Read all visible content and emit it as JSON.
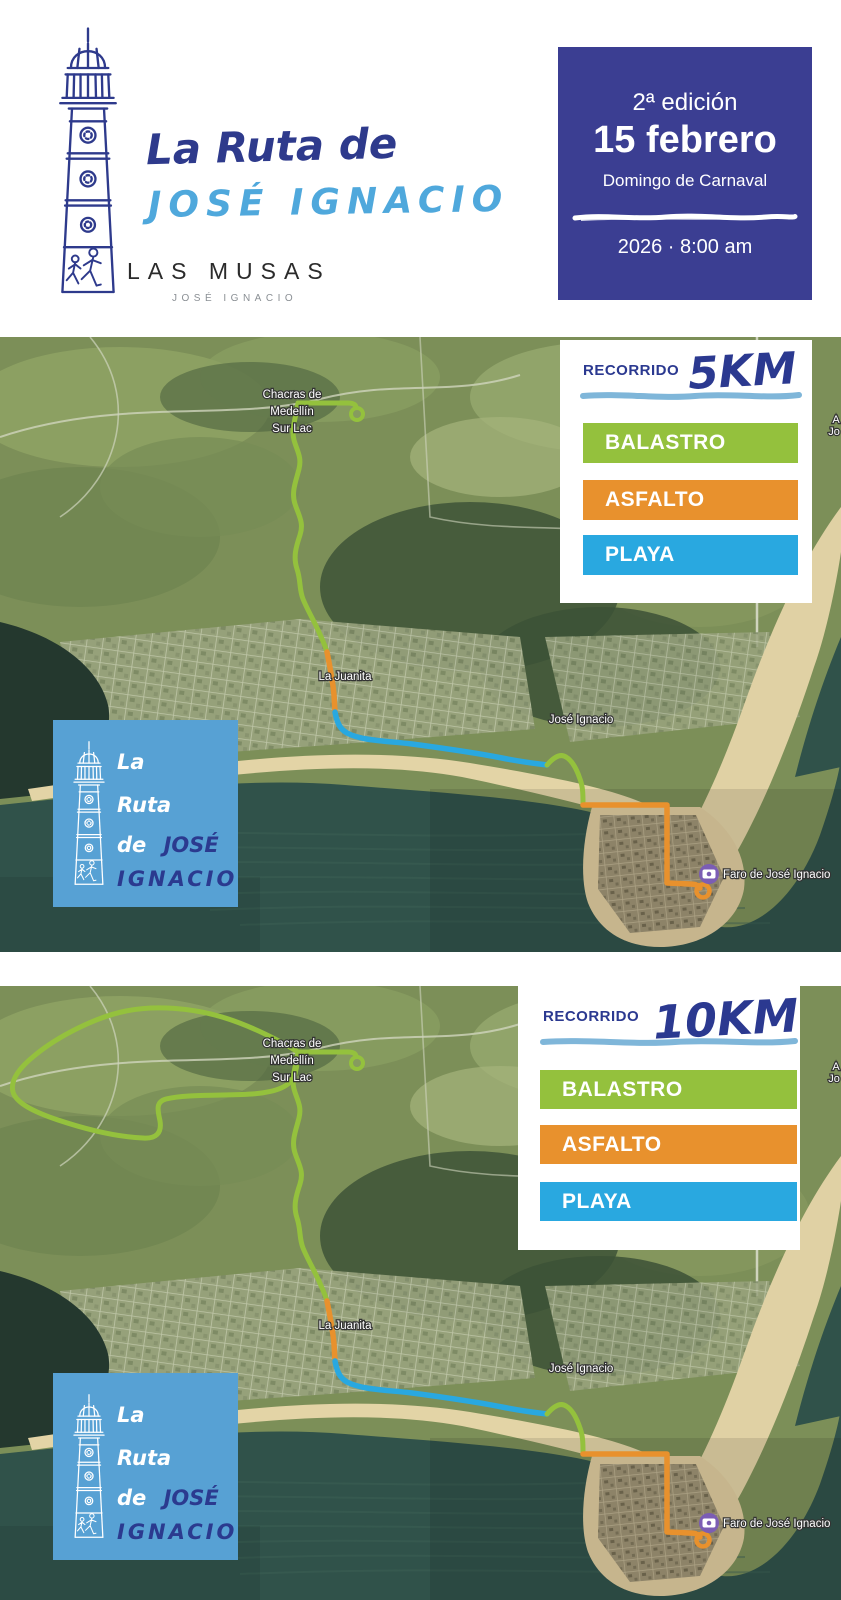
{
  "header": {
    "title_line1": "La Ruta de",
    "title_line2": "JOSÉ IGNACIO",
    "brand": "LAS MUSAS",
    "brand_sub": "JOSÉ IGNACIO",
    "badge": {
      "edition": "2ª edición",
      "date": "15 febrero",
      "subtitle": "Domingo de Carnaval",
      "time": "2026 · 8:00 am",
      "bg_color": "#3b3e92"
    }
  },
  "colors": {
    "navy": "#2e3a8c",
    "light_blue": "#4fa8dc",
    "brush_blue": "#7fb6d9",
    "poi_purple": "#7b5db4"
  },
  "legend": {
    "recorrido_label": "RECORRIDO",
    "items": [
      {
        "label": "BALASTRO",
        "color": "#94c13d"
      },
      {
        "label": "ASFALTO",
        "color": "#e8912d"
      },
      {
        "label": "PLAYA",
        "color": "#29a8e0"
      }
    ]
  },
  "maps": [
    {
      "name": "Recorrido 5KM",
      "distance": "5KM",
      "extended_loop": false
    },
    {
      "name": "Recorrido 10KM",
      "distance": "10KM",
      "extended_loop": true
    }
  ],
  "map_labels": {
    "chacras_line1": "Chacras de",
    "chacras_line2": "Medellín",
    "chacras_line3": "Sur Lac",
    "la_juanita": "La Juanita",
    "jose_ignacio": "José Ignacio",
    "faro": "Faro de José Ignacio",
    "edge_fragment_1": "A",
    "edge_fragment_2": "Jo"
  },
  "overlay_logo": {
    "line1": "La",
    "line2": "Ruta",
    "line3_white": "de",
    "line3_navy": "JOSÉ",
    "line4": "IGNACIO",
    "bg_color": "#57a1d4",
    "text_navy": "#2b3a8f"
  }
}
